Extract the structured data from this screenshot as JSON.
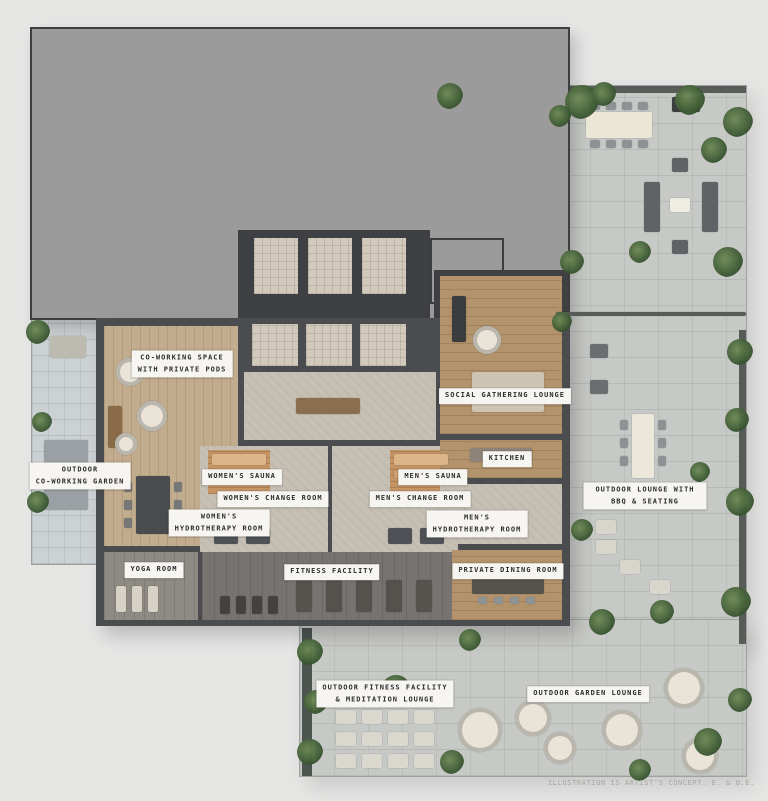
{
  "page": {
    "background_color": "#e5e5e4",
    "type": "amenity-floor-plan-illustration"
  },
  "palette": {
    "roof_block": "#9b9b9b",
    "walls": "#4a4c4f",
    "pavers": "#c7c9c6",
    "wood_floor": "#c2ac8e",
    "sauna_wood": "#c49465",
    "label_background": "#f7f5f1",
    "label_text": "#2c2c2c",
    "greenery": "#49663c"
  },
  "rooms": [
    {
      "id": "co-working-space",
      "label": "CO-WORKING SPACE\nWITH PRIVATE PODS"
    },
    {
      "id": "outdoor-co-working-garden",
      "label": "OUTDOOR\nCO-WORKING GARDEN"
    },
    {
      "id": "womens-sauna",
      "label": "WOMEN'S SAUNA"
    },
    {
      "id": "womens-change-room",
      "label": "WOMEN'S CHANGE ROOM"
    },
    {
      "id": "mens-sauna",
      "label": "MEN'S SAUNA"
    },
    {
      "id": "mens-change-room",
      "label": "MEN'S CHANGE ROOM"
    },
    {
      "id": "womens-hydrotherapy-room",
      "label": "WOMEN'S\nHYDROTHERAPY ROOM"
    },
    {
      "id": "mens-hydrotherapy-room",
      "label": "MEN'S\nHYDROTHERAPY ROOM"
    },
    {
      "id": "yoga-room",
      "label": "YOGA ROOM"
    },
    {
      "id": "fitness-facility",
      "label": "FITNESS FACILITY"
    },
    {
      "id": "social-gathering-lounge",
      "label": "SOCIAL GATHERING LOUNGE"
    },
    {
      "id": "kitchen",
      "label": "KITCHEN"
    },
    {
      "id": "outdoor-lounge-bbq",
      "label": "OUTDOOR LOUNGE WITH BBQ & SEATING"
    },
    {
      "id": "private-dining-room",
      "label": "PRIVATE DINING ROOM"
    },
    {
      "id": "outdoor-fitness-meditation",
      "label": "OUTDOOR FITNESS FACILITY\n& MEDITATION LOUNGE"
    },
    {
      "id": "outdoor-garden-lounge",
      "label": "OUTDOOR GARDEN LOUNGE"
    }
  ],
  "footer": {
    "disclaimer": "ILLUSTRATION IS ARTIST'S CONCEPT. E. & O.E."
  }
}
